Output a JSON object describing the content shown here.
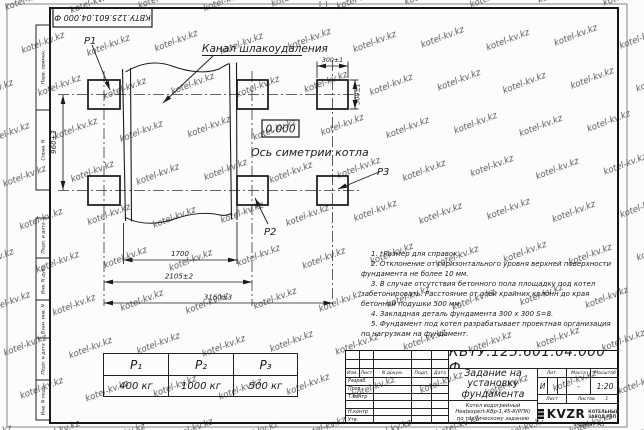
{
  "watermark": {
    "text": "kotel-kv.kz"
  },
  "sheet": {
    "top_doc_number": "КВТУ.125.601.04.000 Ф",
    "format_label": "Формат А3"
  },
  "side_strip": {
    "items": [
      "Перв. примен.",
      "Справ. N",
      "Подп. и дата",
      "Инв. N дубл.",
      "Взам. инв. N",
      "Подп. и дата",
      "Инв. N подл."
    ]
  },
  "drawing": {
    "labels": {
      "channel": "Канал шлакоудаления",
      "axis": "Ось симетрии котла",
      "elevation": "0.000",
      "p1": "P1",
      "p2": "P2",
      "p3": "P3"
    },
    "dims": {
      "v960": "960±3",
      "sq_w": "300±1",
      "sq_h": "300±1",
      "d1700": "1700",
      "d2105": "2105±2",
      "d3160": "3160±3"
    }
  },
  "notes": {
    "lines": [
      "1. *Размер для справок.",
      "2. Отклонение от горизонтального уровня верхней поверхности фундамента не более 10 мм.",
      "3. В случае отсутствия бетонного пола площадку под котел забетонировать. Расстояние от осей крайних колонн до края бетонной подушки 500 мм.",
      "4. Закладная деталь фундамента 300 х 300 S=8.",
      "5. Фундамент под котел разрабатывает проектная организация по нагрузкам на фундамент."
    ]
  },
  "load_table": {
    "headers": [
      "P₁",
      "P₂",
      "P₃"
    ],
    "values": [
      "400 кг",
      "1000 кг",
      "500 кг"
    ]
  },
  "title_block": {
    "doc_number": "КВТУ.125.601.04.000 Ф",
    "title_lines": [
      "Задание на",
      "установку",
      "фундамента"
    ],
    "subtitle_lines": [
      "Котел водогрейный",
      "Heatexpert-КВр-1,45-К(РПК)",
      "по техническому заданию"
    ],
    "header_cols": [
      "Изм.",
      "Лист",
      "N докум.",
      "Подп.",
      "Дата"
    ],
    "sign_rows": [
      "Разраб.",
      "Пров.",
      "Т.контр",
      "",
      "Н.контр",
      "Утв."
    ],
    "lit_label": "Лит.",
    "mass_label": "Масса",
    "scale_label": "Масштаб",
    "lit_value": "И",
    "mass_value": "-",
    "scale_value": "1:20",
    "sheet_label": "Лист",
    "sheets_label": "Листов",
    "sheets_value": "1",
    "logo_text": "KVZR",
    "logo_caption": [
      "КОТЕЛЬНЫЙ",
      "ЗАВОД РЭП"
    ]
  }
}
